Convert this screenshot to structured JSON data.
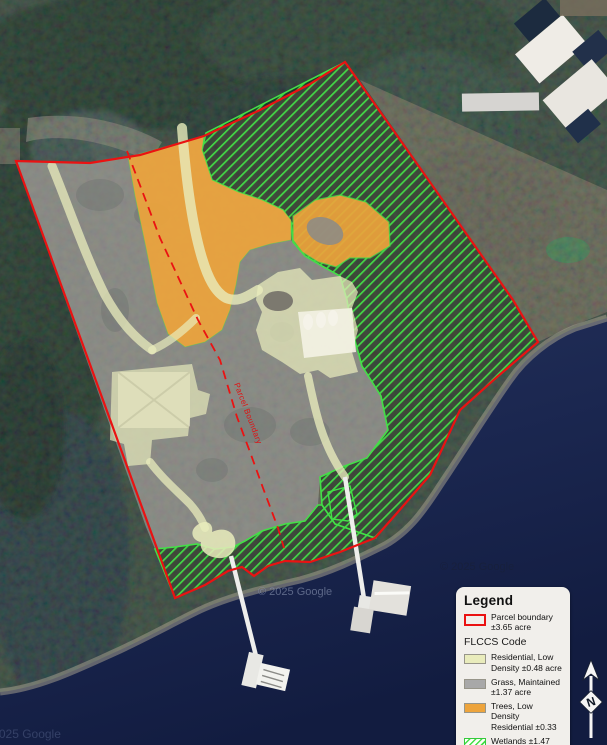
{
  "map": {
    "parcel_divider_label": "Parcel Boundary",
    "watermark_main": "© 2025 Google",
    "watermark_secondary": "© 2025 Google",
    "watermark_corner": "© 2025 Google"
  },
  "legend": {
    "title": "Legend",
    "parcel_item": {
      "label": "Parcel boundary ±3.65 acre"
    },
    "section": "FLCCS Code",
    "items": [
      {
        "label": "Residential, Low Density ±0.48 acre",
        "swatch": "residential"
      },
      {
        "label": "Grass, Maintained ±1.37 acre",
        "swatch": "grass"
      },
      {
        "label": "Trees, Low Density Residential ±0.33",
        "swatch": "trees"
      },
      {
        "label": "Wetlands ±1.47 acre",
        "swatch": "wetlands"
      }
    ]
  },
  "north_arrow": {
    "label": "N"
  },
  "colors": {
    "parcel_boundary": "#ea1212",
    "residential": "#e9ecbc",
    "grass": "#a8a8a8",
    "trees": "#eda43c",
    "wetlands_line": "#43df47",
    "water": "#1b2750",
    "legend_bg": "#f1efeb"
  }
}
